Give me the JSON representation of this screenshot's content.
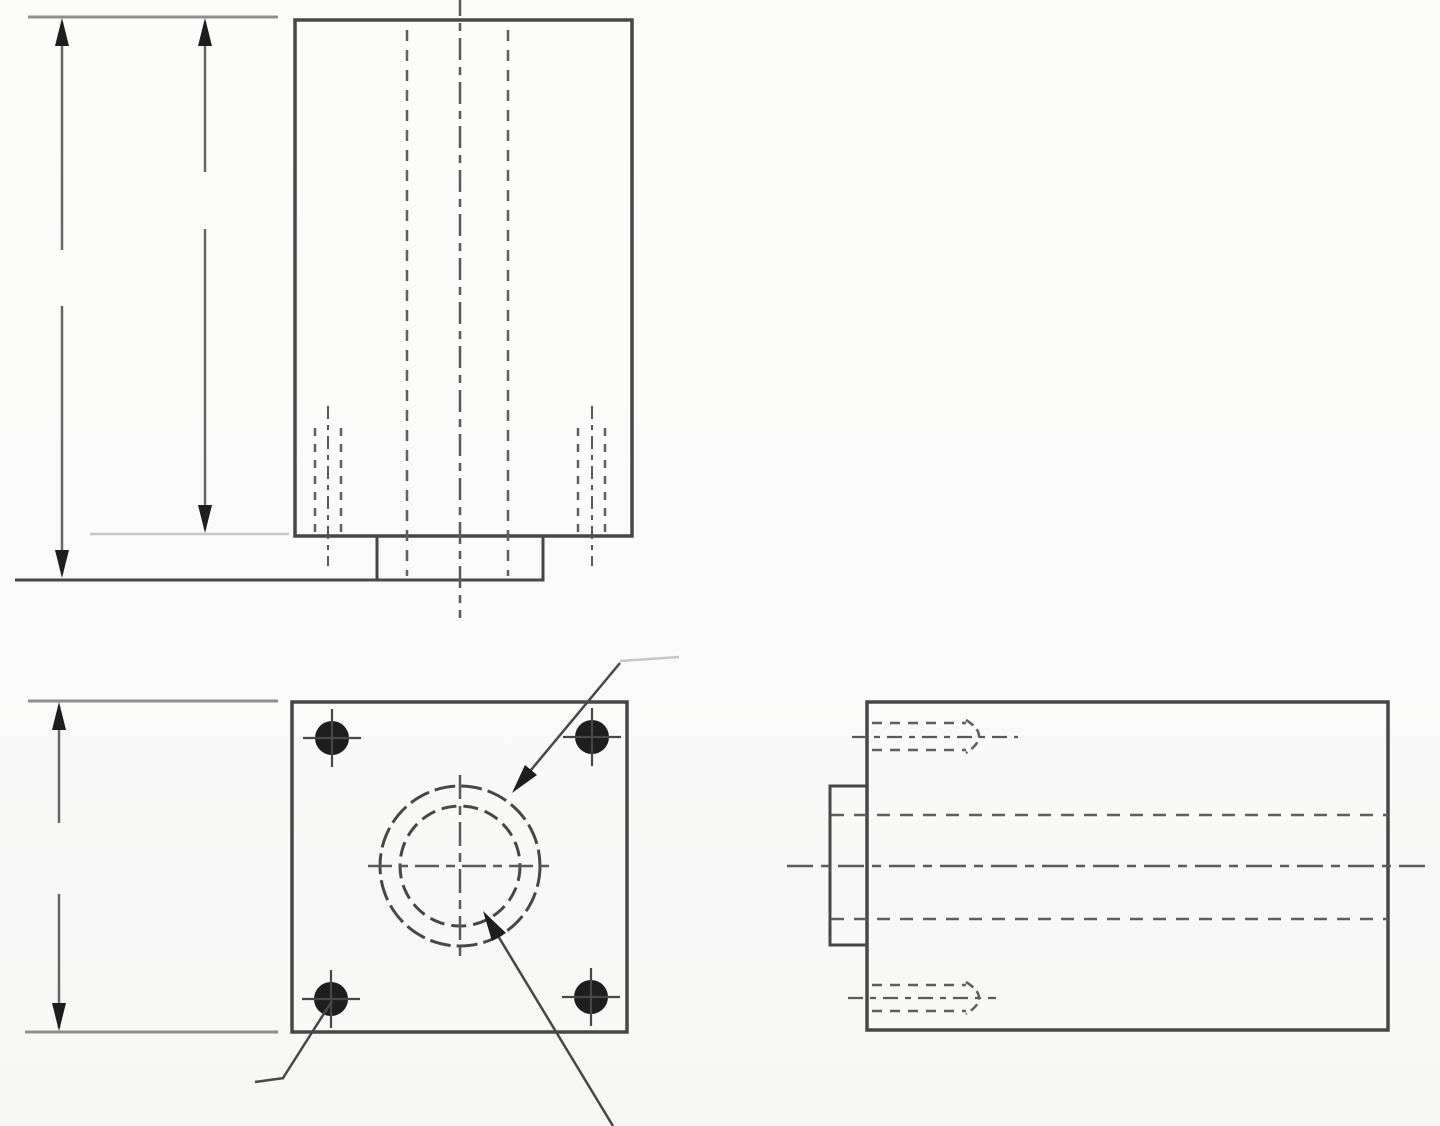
{
  "canvas": {
    "width": 1440,
    "height": 1126,
    "background": "#fbfbfa"
  },
  "palette": {
    "outline": "#474747",
    "hidden": "#5f5f5f",
    "centerline": "#595959",
    "dimension": "#666666",
    "extension": "#8f8f8f",
    "faint": "#c6c6c6",
    "ink": "#1e1e1e"
  },
  "views": {
    "front-view": {
      "primitives": [
        {
          "name": "top-extension-line",
          "kind": "line",
          "x1": 28,
          "y1": 17,
          "x2": 278,
          "y2": 17,
          "stroke": "extension",
          "w": 3
        },
        {
          "name": "overall-height-dim-shaft-upper",
          "kind": "line",
          "x1": 62,
          "y1": 22,
          "x2": 62,
          "y2": 250,
          "stroke": "dimension",
          "w": 2.5
        },
        {
          "name": "overall-height-dim-shaft-lower",
          "kind": "line",
          "x1": 62,
          "y1": 306,
          "x2": 62,
          "y2": 574,
          "stroke": "dimension",
          "w": 2.5
        },
        {
          "name": "overall-height-dim-arrow-up",
          "kind": "poly",
          "pts": "62,18 55,46 69,46",
          "fill": "ink"
        },
        {
          "name": "overall-height-dim-arrow-down",
          "kind": "poly",
          "pts": "62,578 55,550 69,550",
          "fill": "ink"
        },
        {
          "name": "body-height-dim-shaft-upper",
          "kind": "line",
          "x1": 205,
          "y1": 22,
          "x2": 205,
          "y2": 172,
          "stroke": "dimension",
          "w": 2.5
        },
        {
          "name": "body-height-dim-shaft-lower",
          "kind": "line",
          "x1": 205,
          "y1": 229,
          "x2": 205,
          "y2": 529,
          "stroke": "dimension",
          "w": 2.5
        },
        {
          "name": "body-height-dim-arrow-up",
          "kind": "poly",
          "pts": "205,18 198,46 212,46",
          "fill": "ink"
        },
        {
          "name": "body-height-dim-arrow-down",
          "kind": "poly",
          "pts": "205,533 198,505 212,505",
          "fill": "ink"
        },
        {
          "name": "body-bottom-extension-faint",
          "kind": "line",
          "x1": 90,
          "y1": 534,
          "x2": 289,
          "y2": 534,
          "stroke": "faint",
          "w": 2.5
        },
        {
          "name": "body-outline",
          "kind": "rect",
          "x": 295,
          "y": 20,
          "wd": 337,
          "ht": 516,
          "stroke": "outline",
          "w": 3.5
        },
        {
          "name": "mounting-boss-outline",
          "kind": "rect",
          "x": 377,
          "y": 536,
          "wd": 166,
          "ht": 44,
          "stroke": "outline",
          "w": 3
        },
        {
          "name": "base-extension-line",
          "kind": "line",
          "x1": 15,
          "y1": 580,
          "x2": 378,
          "y2": 580,
          "stroke": "outline",
          "w": 3
        },
        {
          "name": "bore-hidden-line-left",
          "kind": "line",
          "x1": 407,
          "y1": 30,
          "x2": 407,
          "y2": 576,
          "stroke": "hidden",
          "w": 2.5,
          "dash": "11,9"
        },
        {
          "name": "vertical-centerline",
          "kind": "line",
          "x1": 460,
          "y1": -6,
          "x2": 460,
          "y2": 618,
          "stroke": "centerline",
          "w": 2.5,
          "dash": "22,7,8,7"
        },
        {
          "name": "bore-hidden-line-right",
          "kind": "line",
          "x1": 508,
          "y1": 30,
          "x2": 508,
          "y2": 576,
          "stroke": "hidden",
          "w": 2.5,
          "dash": "11,9"
        },
        {
          "name": "tapped-hole-left-thread-a",
          "kind": "line",
          "x1": 315,
          "y1": 428,
          "x2": 315,
          "y2": 534,
          "stroke": "hidden",
          "w": 2.5,
          "dash": "8,8"
        },
        {
          "name": "tapped-hole-left-thread-b",
          "kind": "line",
          "x1": 341,
          "y1": 428,
          "x2": 341,
          "y2": 534,
          "stroke": "hidden",
          "w": 2.5,
          "dash": "8,8"
        },
        {
          "name": "tapped-hole-left-centerline",
          "kind": "line",
          "x1": 328,
          "y1": 406,
          "x2": 328,
          "y2": 566,
          "stroke": "centerline",
          "w": 2,
          "dash": "13,6,5,6"
        },
        {
          "name": "tapped-hole-right-thread-a",
          "kind": "line",
          "x1": 578,
          "y1": 428,
          "x2": 578,
          "y2": 534,
          "stroke": "hidden",
          "w": 2.5,
          "dash": "8,8"
        },
        {
          "name": "tapped-hole-right-thread-b",
          "kind": "line",
          "x1": 605,
          "y1": 428,
          "x2": 605,
          "y2": 534,
          "stroke": "hidden",
          "w": 2.5,
          "dash": "8,8"
        },
        {
          "name": "tapped-hole-right-centerline",
          "kind": "line",
          "x1": 592,
          "y1": 406,
          "x2": 592,
          "y2": 566,
          "stroke": "centerline",
          "w": 2,
          "dash": "13,6,5,6"
        }
      ]
    },
    "plan-view": {
      "primitives": [
        {
          "name": "top-extension-line",
          "kind": "line",
          "x1": 28,
          "y1": 701,
          "x2": 278,
          "y2": 701,
          "stroke": "extension",
          "w": 3
        },
        {
          "name": "bottom-extension-line",
          "kind": "line",
          "x1": 25,
          "y1": 1032,
          "x2": 278,
          "y2": 1032,
          "stroke": "extension",
          "w": 3
        },
        {
          "name": "height-dim-shaft-upper",
          "kind": "line",
          "x1": 59,
          "y1": 706,
          "x2": 59,
          "y2": 823,
          "stroke": "dimension",
          "w": 2.5
        },
        {
          "name": "height-dim-shaft-lower",
          "kind": "line",
          "x1": 59,
          "y1": 894,
          "x2": 59,
          "y2": 1028,
          "stroke": "dimension",
          "w": 2.5
        },
        {
          "name": "height-dim-arrow-up",
          "kind": "poly",
          "pts": "59,702 52,730 66,730",
          "fill": "ink"
        },
        {
          "name": "height-dim-arrow-down",
          "kind": "poly",
          "pts": "59,1031 52,1003 66,1003",
          "fill": "ink"
        },
        {
          "name": "plate-outline",
          "kind": "rect",
          "x": 292,
          "y": 702,
          "wd": 335,
          "ht": 330,
          "stroke": "outline",
          "w": 3.5
        },
        {
          "name": "mount-hole-top-left",
          "kind": "circle",
          "cx": 332,
          "cy": 738,
          "r": 17,
          "fill": "ink"
        },
        {
          "name": "mount-hole-top-right",
          "kind": "circle",
          "cx": 592,
          "cy": 737,
          "r": 17,
          "fill": "ink"
        },
        {
          "name": "mount-hole-bottom-left",
          "kind": "circle",
          "cx": 331,
          "cy": 999,
          "r": 17,
          "fill": "ink"
        },
        {
          "name": "mount-hole-bottom-right",
          "kind": "circle",
          "cx": 591,
          "cy": 997,
          "r": 17,
          "fill": "ink"
        },
        {
          "name": "mount-hole-tl-tick-v",
          "kind": "line",
          "x1": 332,
          "y1": 709,
          "x2": 332,
          "y2": 767,
          "stroke": "outline",
          "w": 2.2
        },
        {
          "name": "mount-hole-tl-tick-h",
          "kind": "line",
          "x1": 303,
          "y1": 738,
          "x2": 361,
          "y2": 738,
          "stroke": "outline",
          "w": 2.2
        },
        {
          "name": "mount-hole-tr-tick-v",
          "kind": "line",
          "x1": 592,
          "y1": 708,
          "x2": 592,
          "y2": 766,
          "stroke": "outline",
          "w": 2.2
        },
        {
          "name": "mount-hole-tr-tick-h",
          "kind": "line",
          "x1": 563,
          "y1": 737,
          "x2": 621,
          "y2": 737,
          "stroke": "outline",
          "w": 2.2
        },
        {
          "name": "mount-hole-bl-tick-v",
          "kind": "line",
          "x1": 331,
          "y1": 970,
          "x2": 331,
          "y2": 1028,
          "stroke": "outline",
          "w": 2.2
        },
        {
          "name": "mount-hole-bl-tick-h",
          "kind": "line",
          "x1": 302,
          "y1": 999,
          "x2": 360,
          "y2": 999,
          "stroke": "outline",
          "w": 2.2
        },
        {
          "name": "mount-hole-br-tick-v",
          "kind": "line",
          "x1": 591,
          "y1": 968,
          "x2": 591,
          "y2": 1026,
          "stroke": "outline",
          "w": 2.2
        },
        {
          "name": "mount-hole-br-tick-h",
          "kind": "line",
          "x1": 562,
          "y1": 997,
          "x2": 620,
          "y2": 997,
          "stroke": "outline",
          "w": 2.2
        },
        {
          "name": "counterbore-circle",
          "kind": "circle",
          "cx": 460,
          "cy": 866,
          "r": 80,
          "stroke": "outline",
          "w": 3,
          "dash": "21,6"
        },
        {
          "name": "bore-circle",
          "kind": "circle",
          "cx": 460,
          "cy": 866,
          "r": 60,
          "stroke": "outline",
          "w": 3,
          "dash": "15,7"
        },
        {
          "name": "bore-centerline-h",
          "kind": "line",
          "x1": 368,
          "y1": 866,
          "x2": 553,
          "y2": 866,
          "stroke": "centerline",
          "w": 2.5,
          "dash": "24,7,9,7"
        },
        {
          "name": "bore-centerline-v",
          "kind": "line",
          "x1": 460,
          "y1": 775,
          "x2": 460,
          "y2": 961,
          "stroke": "centerline",
          "w": 2.5,
          "dash": "24,7,9,7"
        },
        {
          "name": "counterbore-leader-line",
          "kind": "line",
          "x1": 516,
          "y1": 788,
          "x2": 620,
          "y2": 663,
          "stroke": "outline",
          "w": 2.5
        },
        {
          "name": "counterbore-leader-tick",
          "kind": "line",
          "x1": 620,
          "y1": 661,
          "x2": 679,
          "y2": 657,
          "stroke": "faint",
          "w": 2.5
        },
        {
          "name": "counterbore-leader-arrow",
          "kind": "poly",
          "pts": "512,793 537,775 525,765",
          "fill": "ink"
        },
        {
          "name": "bore-leader-line",
          "kind": "line",
          "x1": 489,
          "y1": 921,
          "x2": 613,
          "y2": 1126,
          "stroke": "outline",
          "w": 2.5
        },
        {
          "name": "bore-leader-arrow",
          "kind": "poly",
          "pts": "483,911 492,941 506,933",
          "fill": "ink"
        },
        {
          "name": "mount-hole-leader-line",
          "kind": "line",
          "x1": 332,
          "y1": 1001,
          "x2": 283,
          "y2": 1078,
          "stroke": "outline",
          "w": 2.5
        },
        {
          "name": "mount-hole-leader-tick",
          "kind": "line",
          "x1": 255,
          "y1": 1082,
          "x2": 284,
          "y2": 1078,
          "stroke": "outline",
          "w": 2.5
        }
      ]
    },
    "side-view": {
      "primitives": [
        {
          "name": "body-outline",
          "kind": "rect",
          "x": 867,
          "y": 702,
          "wd": 521,
          "ht": 328,
          "stroke": "outline",
          "w": 3.5
        },
        {
          "name": "boss-outline",
          "kind": "rect",
          "x": 830,
          "y": 786,
          "wd": 37,
          "ht": 159,
          "stroke": "outline",
          "w": 3
        },
        {
          "name": "horizontal-centerline",
          "kind": "line",
          "x1": 787,
          "y1": 866,
          "x2": 1428,
          "y2": 866,
          "stroke": "centerline",
          "w": 2.5,
          "dash": "26,8,9,8"
        },
        {
          "name": "bore-hidden-top",
          "kind": "line",
          "x1": 831,
          "y1": 815,
          "x2": 1388,
          "y2": 815,
          "stroke": "hidden",
          "w": 2.5,
          "dash": "13,10"
        },
        {
          "name": "bore-hidden-bottom",
          "kind": "line",
          "x1": 831,
          "y1": 919,
          "x2": 1388,
          "y2": 919,
          "stroke": "hidden",
          "w": 2.5,
          "dash": "13,10"
        },
        {
          "name": "tap-top-thread-upper",
          "kind": "line",
          "x1": 872,
          "y1": 723,
          "x2": 966,
          "y2": 723,
          "stroke": "hidden",
          "w": 2.5,
          "dash": "10,8"
        },
        {
          "name": "tap-top-centerline",
          "kind": "line",
          "x1": 852,
          "y1": 737,
          "x2": 1018,
          "y2": 737,
          "stroke": "centerline",
          "w": 2.2,
          "dash": "15,7,6,7"
        },
        {
          "name": "tap-top-thread-lower",
          "kind": "line",
          "x1": 872,
          "y1": 750,
          "x2": 966,
          "y2": 750,
          "stroke": "hidden",
          "w": 2.5,
          "dash": "10,8"
        },
        {
          "name": "tap-top-drill-point",
          "kind": "path",
          "d": "M 966 720 Q 992 736 966 753",
          "stroke": "hidden",
          "w": 2.5,
          "dash": "9,5"
        },
        {
          "name": "tap-bottom-thread-upper",
          "kind": "line",
          "x1": 872,
          "y1": 985,
          "x2": 966,
          "y2": 985,
          "stroke": "hidden",
          "w": 2.5,
          "dash": "10,8"
        },
        {
          "name": "tap-bottom-centerline",
          "kind": "line",
          "x1": 848,
          "y1": 998,
          "x2": 996,
          "y2": 998,
          "stroke": "centerline",
          "w": 2.2,
          "dash": "15,7,6,7"
        },
        {
          "name": "tap-bottom-thread-lower",
          "kind": "line",
          "x1": 872,
          "y1": 1011,
          "x2": 966,
          "y2": 1011,
          "stroke": "hidden",
          "w": 2.5,
          "dash": "10,8"
        },
        {
          "name": "tap-bottom-drill-point",
          "kind": "path",
          "d": "M 966 982 Q 992 998 966 1014",
          "stroke": "hidden",
          "w": 2.5,
          "dash": "9,5"
        }
      ]
    }
  }
}
